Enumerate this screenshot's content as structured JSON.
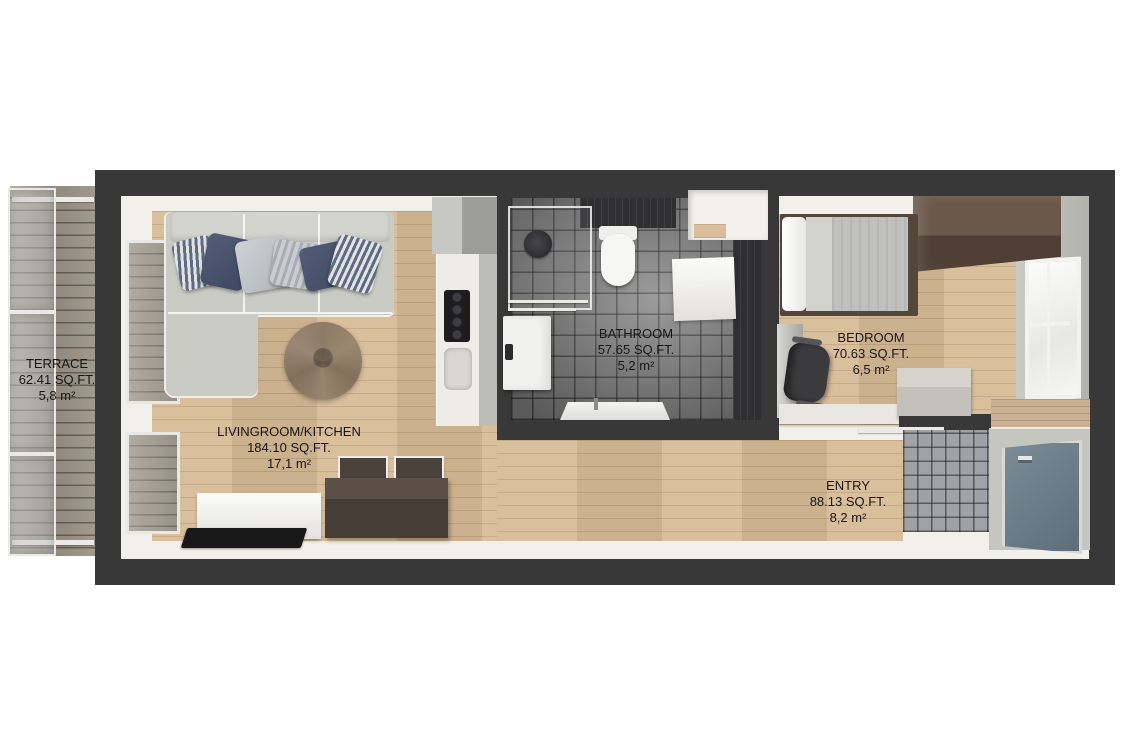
{
  "plan_title": "apartment-floor-plan",
  "rooms": [
    {
      "id": "terrace",
      "name": "TERRACE",
      "area_sqft": "62.41 SQ.FT.",
      "area_m2": "5,8 m²"
    },
    {
      "id": "livingroom",
      "name": "LIVINGROOM/KITCHEN",
      "area_sqft": "184.10 SQ.FT.",
      "area_m2": "17,1 m²"
    },
    {
      "id": "bathroom",
      "name": "BATHROOM",
      "area_sqft": "57.65 SQ.FT.",
      "area_m2": "5,2 m²"
    },
    {
      "id": "bedroom",
      "name": "BEDROOM",
      "area_sqft": "70.63 SQ.FT.",
      "area_m2": "6,5 m²"
    },
    {
      "id": "entry",
      "name": "ENTRY",
      "area_sqft": "88.13 SQ.FT.",
      "area_m2": "8,2 m²"
    }
  ],
  "colors": {
    "background": "#ffffff",
    "wall": "#383838",
    "inner_wall_face": "#f2f0ea",
    "wood_floor": "#d7ba96",
    "terrace_deck": "#9c9487",
    "bathroom_tile": "#7d7d7d",
    "entry_tile": "#a0a2a4",
    "sofa": "#cbcbc5",
    "pillow_navy": "#49536b",
    "rug": "#8d7b66",
    "wardrobe": "#5d4a3d",
    "entry_door": "#6b7f8c",
    "label_text": "#161616"
  }
}
